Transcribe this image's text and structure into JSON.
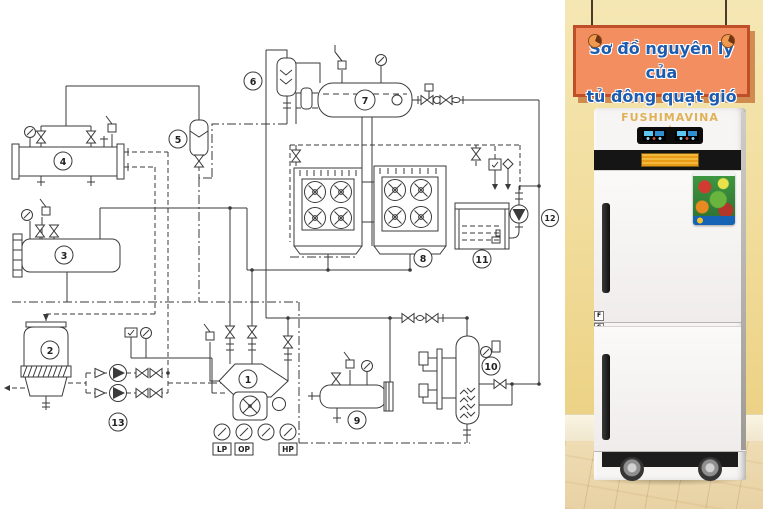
{
  "signboard": {
    "line1": "Sơ đồ nguyên lý của",
    "line2": "tủ đông quạt gió"
  },
  "freezer": {
    "brand": "FUSHIMAVINA",
    "stars_left": "★★★",
    "star_center": "★",
    "stars_right": "★★★",
    "door_top_label": "F",
    "door_bottom_label": "C"
  },
  "schematic": {
    "labels": [
      "1",
      "2",
      "3",
      "4",
      "5",
      "6",
      "7",
      "8",
      "9",
      "10",
      "11",
      "12",
      "13"
    ],
    "gauge_labels": [
      "LP",
      "OP",
      "HP"
    ]
  },
  "colors": {
    "sign_bg": "#f28e60",
    "sign_border": "#bf4f28",
    "sign_text": "#1c5cb0",
    "wall": "#f1dc9b",
    "brand_gold": "#dfb257",
    "line": "#3a3a3a"
  }
}
